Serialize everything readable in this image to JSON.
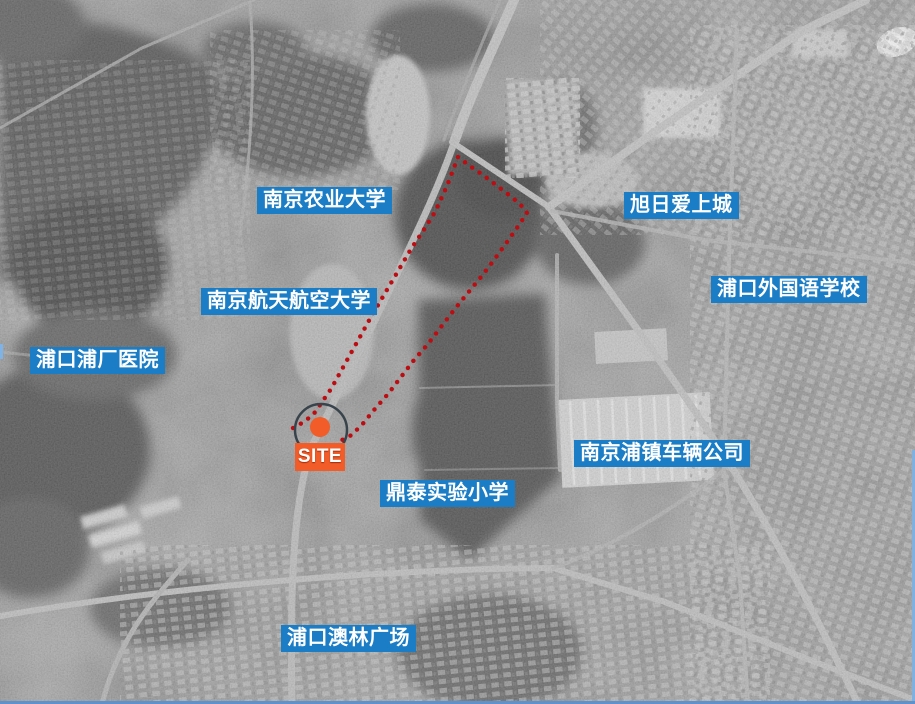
{
  "page": {
    "type": "satellite-site-location-map"
  },
  "colors": {
    "label_bg": "#1b7dc6",
    "label_text": "#ffffff",
    "boundary_red": "#bb0d12",
    "site_orange": "#f15c28",
    "circle_outline": "#39434b",
    "border_blue": "#5f92cd"
  },
  "labels": [
    {
      "id": "nanjing-agricultural-university",
      "text": "南京农业大学"
    },
    {
      "id": "xuri-aishangcheng",
      "text": "旭日爱上城"
    },
    {
      "id": "pukou-foreign-language-school",
      "text": "浦口外国语学校"
    },
    {
      "id": "nanjing-hangtian-hangkong-university",
      "text": "南京航天航空大学"
    },
    {
      "id": "pukou-puchang-hospital",
      "text": "浦口浦厂医院"
    },
    {
      "id": "nanjing-puzhen-vehicle-company",
      "text": "南京浦镇车辆公司"
    },
    {
      "id": "dingtai-experimental-primary-school",
      "text": "鼎泰实验小学"
    },
    {
      "id": "pukou-aolin-plaza",
      "text": "浦口澳林广场"
    }
  ],
  "site_marker": {
    "label": "SITE"
  }
}
